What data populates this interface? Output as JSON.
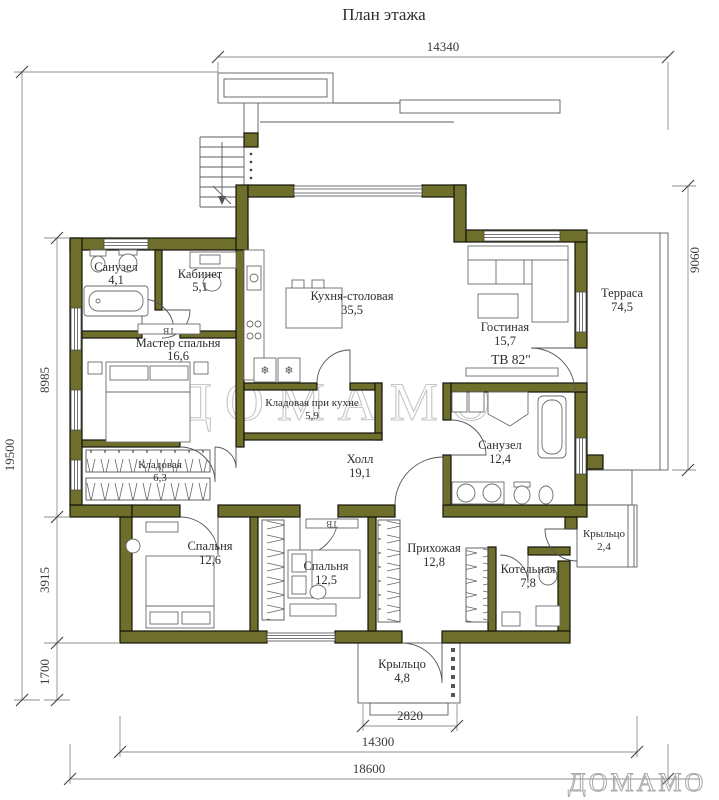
{
  "title": "План этажа",
  "watermark": {
    "center": "ДОМАМО",
    "corner": "ДОМАМО"
  },
  "colors": {
    "wall": "#6f6f2c",
    "line": "#5c5c5c",
    "dim": "#8f8f8f"
  },
  "rooms": [
    {
      "name": "Санузел",
      "area": "4,1"
    },
    {
      "name": "Кабинет",
      "area": "5,1"
    },
    {
      "name": "Мастер спальня",
      "area": "16,6"
    },
    {
      "name": "Кухня-столовая",
      "area": "35,5"
    },
    {
      "name": "Гостиная",
      "area": "15,7"
    },
    {
      "name": "Терраса",
      "area": "74,5"
    },
    {
      "name": "Кладовая при кухне",
      "area": "5,9"
    },
    {
      "name": "Холл",
      "area": "19,1"
    },
    {
      "name": "Санузел",
      "area": "12,4"
    },
    {
      "name": "Кладовая",
      "area": "6,3"
    },
    {
      "name": "Спальня",
      "area": "12,6"
    },
    {
      "name": "Спальня",
      "area": "12,5"
    },
    {
      "name": "Прихожая",
      "area": "12,8"
    },
    {
      "name": "Котельная",
      "area": "7,8"
    },
    {
      "name": "Крыльцо",
      "area": "2,4"
    },
    {
      "name": "Крыльцо",
      "area": "4,8"
    }
  ],
  "labels": {
    "tv_living": "ТВ  82\"",
    "tv_small": "ТВ",
    "fridge": "❄"
  },
  "dimensions": {
    "top": "14340",
    "right": "9060",
    "left_total": "19500",
    "left_chain": [
      "8985",
      "3915",
      "1700"
    ],
    "bottom_porch": "2820",
    "bottom_inner": "14300",
    "bottom_total": "18600"
  }
}
